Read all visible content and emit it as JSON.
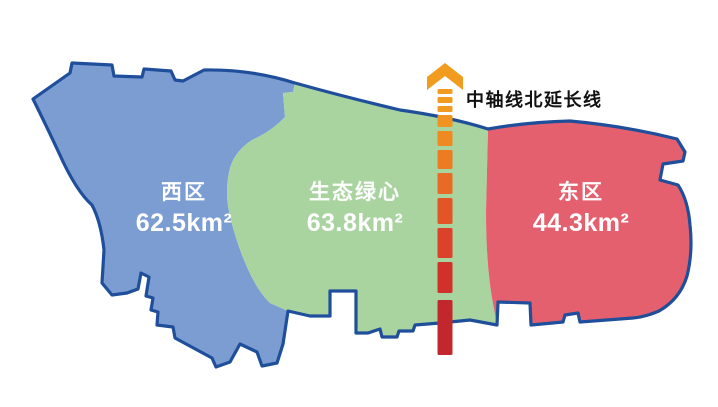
{
  "map": {
    "background_color": "#ffffff",
    "outline_color": "#1f4e9b",
    "regions": [
      {
        "id": "west",
        "name": "西区",
        "area": "62.5km²",
        "fill_color": "#7b9dd2"
      },
      {
        "id": "green-heart",
        "name": "生态绿心",
        "area": "63.8km²",
        "fill_color": "#a9d4a0"
      },
      {
        "id": "east",
        "name": "东区",
        "area": "44.3km²",
        "fill_color": "#e4606e"
      }
    ],
    "axis": {
      "label": "中轴线北延长线",
      "label_color": "#111111",
      "arrow_color": "#f29c1f",
      "start_color": "#f29c1f",
      "end_color": "#c1272d",
      "dashes": [
        {
          "y": 89,
          "h": 5,
          "color": "#f29c1f"
        },
        {
          "y": 97,
          "h": 6,
          "color": "#f29c1f"
        },
        {
          "y": 106,
          "h": 6,
          "color": "#f19a1f"
        },
        {
          "y": 115,
          "h": 12,
          "color": "#f0941f"
        },
        {
          "y": 131,
          "h": 15,
          "color": "#ee8a20"
        },
        {
          "y": 150,
          "h": 19,
          "color": "#ec7b22"
        },
        {
          "y": 173,
          "h": 21,
          "color": "#e96a24"
        },
        {
          "y": 198,
          "h": 26,
          "color": "#e35427"
        },
        {
          "y": 228,
          "h": 30,
          "color": "#dc4129"
        },
        {
          "y": 262,
          "h": 31,
          "color": "#d2312b"
        },
        {
          "y": 300,
          "h": 55,
          "color": "#c1272d"
        }
      ]
    }
  }
}
